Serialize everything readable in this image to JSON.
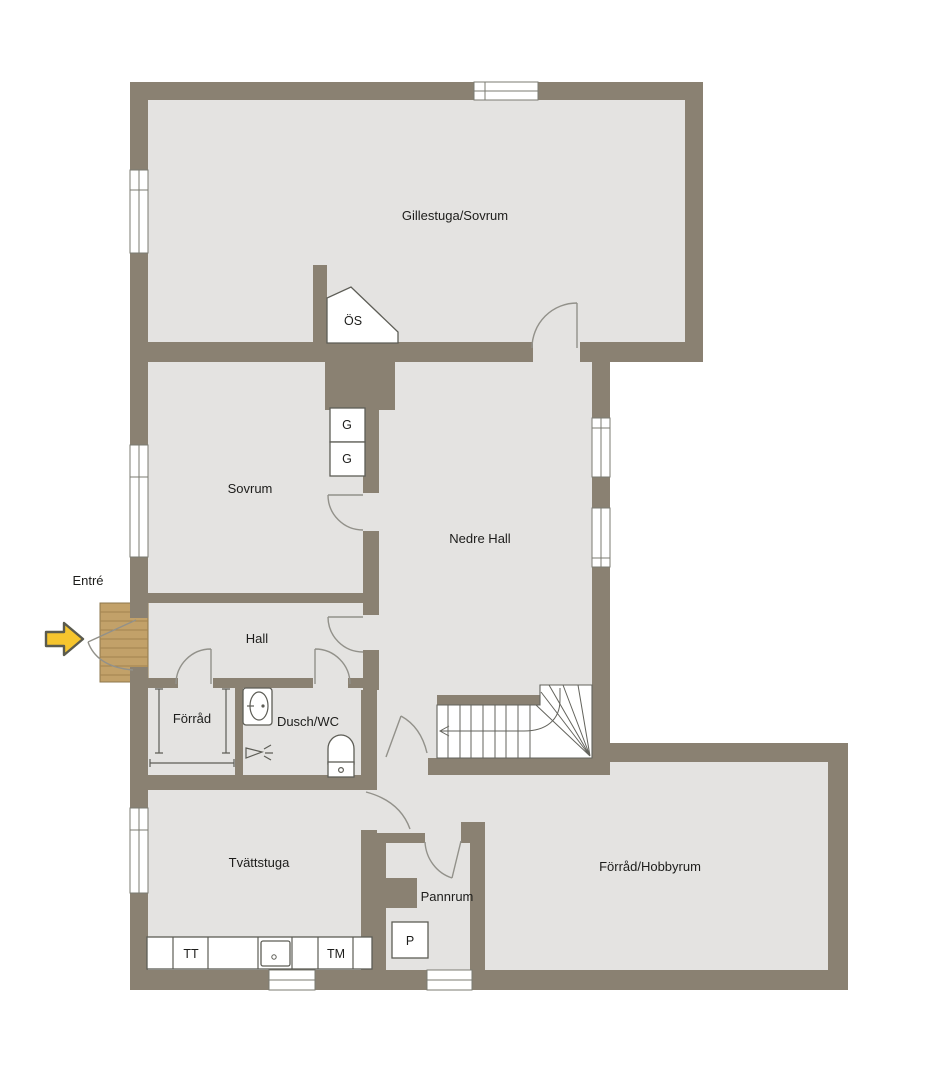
{
  "plan": {
    "rooms": {
      "gillestuga": "Gillestuga/Sovrum",
      "sovrum": "Sovrum",
      "nedre_hall": "Nedre Hall",
      "hall": "Hall",
      "forrad": "Förråd",
      "dusch_wc": "Dusch/WC",
      "tvattstuga": "Tvättstuga",
      "pannrum": "Pannrum",
      "forrad_hobbyrum": "Förråd/Hobbyrum"
    },
    "annotations": {
      "entrance": "Entré",
      "fireplace": "ÖS"
    },
    "fixtures": {
      "wardrobe_1": "G",
      "wardrobe_2": "G",
      "dryer": "TT",
      "washer": "TM",
      "boiler": "P"
    },
    "colors": {
      "wall": "#8a8172",
      "floor": "#e4e3e1",
      "deck": "#c2a169",
      "arrow_yellow": "#f6c52e",
      "background": "#ffffff"
    }
  }
}
